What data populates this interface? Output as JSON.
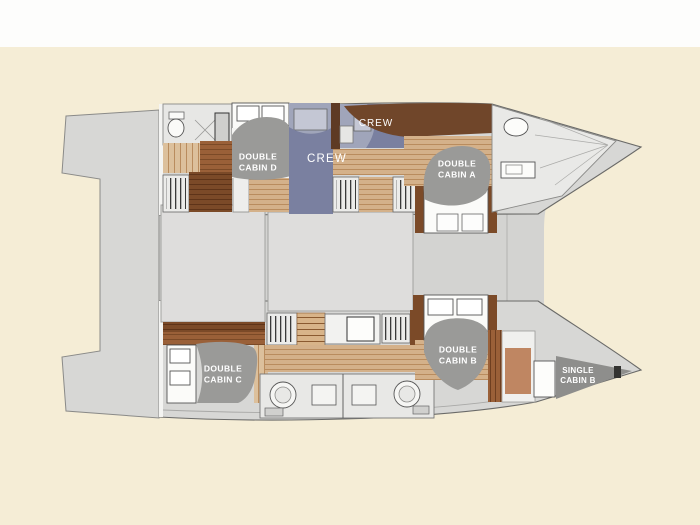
{
  "diagram": {
    "kind": "catamaran-deck-plan",
    "labels": {
      "cabin_d": "DOUBLE\nCABIN D",
      "crew_main": "CREW",
      "crew_forward": "CREW",
      "cabin_a": "DOUBLE\nCABIN A",
      "cabin_c": "DOUBLE\nCABIN C",
      "cabin_b": "DOUBLE\nCABIN B",
      "single_b": "SINGLE\nCABIN B"
    },
    "colors": {
      "background": "#f5edd6",
      "top_band": "#fdfdfc",
      "deck_gray": "#d3d3d1",
      "saloon_gray": "#dedddc",
      "label_gray": "#9a9a98",
      "label_text": "#ffffff",
      "wood_tan": "#d4b18a",
      "wood_brown": "#9a6038",
      "wood_dark": "#7b4a28",
      "crew_blue": "#a0a5ba",
      "crew_blue_dark": "#7a80a0",
      "terracotta": "#bf8662"
    }
  }
}
